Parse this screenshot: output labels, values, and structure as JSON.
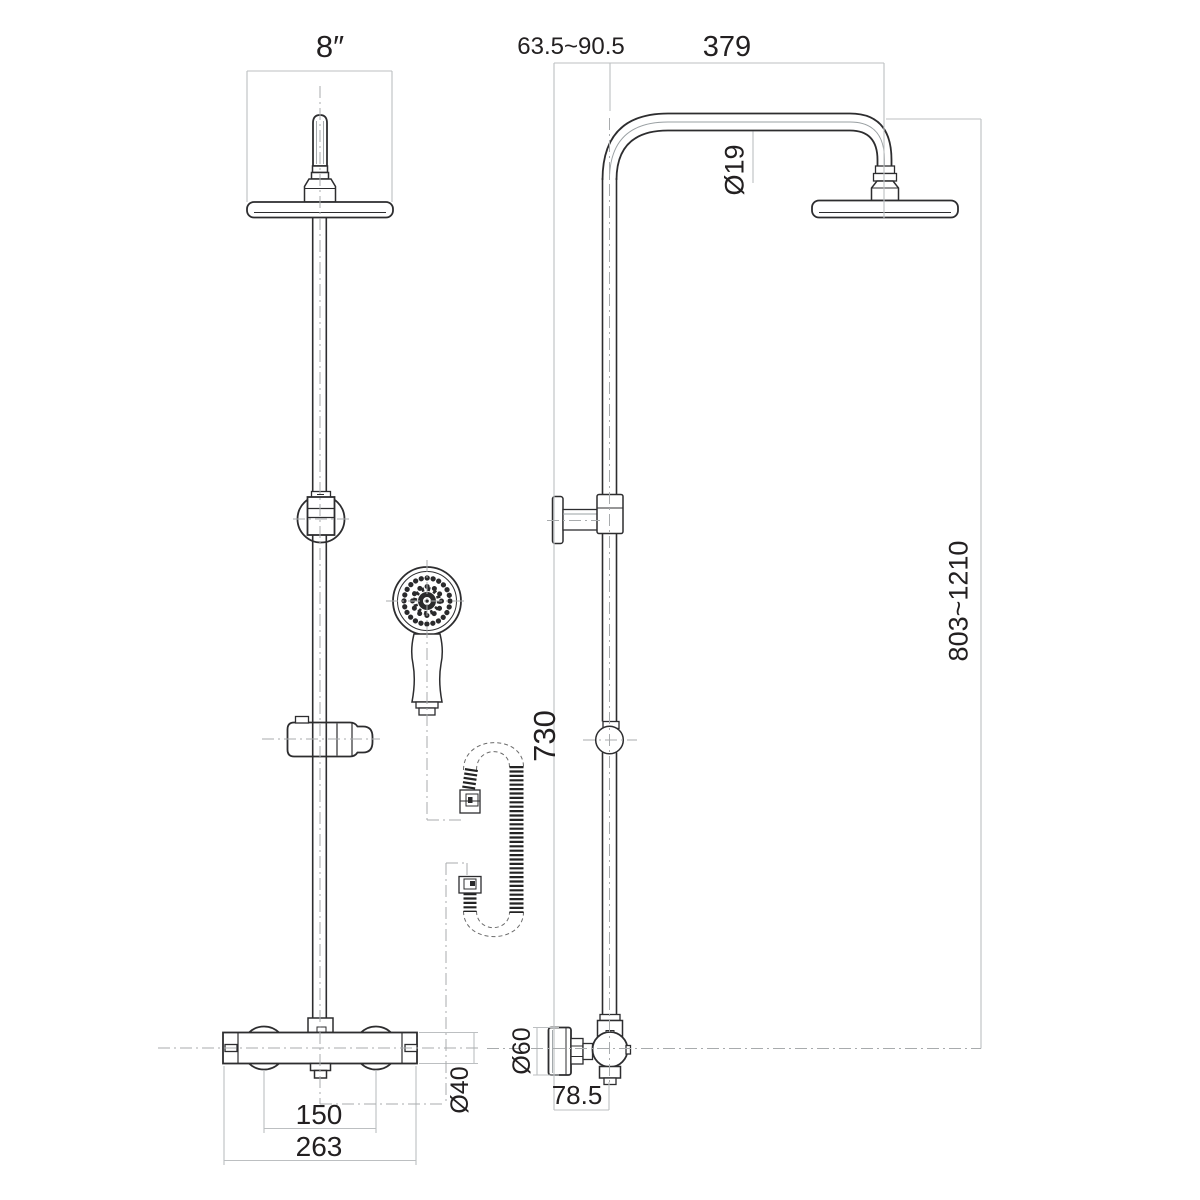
{
  "drawing": {
    "type": "technical dimension drawing",
    "subject": "Thermostatic shower column with overhead rain head, hand shower, hose and bar mixer valve",
    "views": {
      "left": "front elevation",
      "right": "side elevation"
    }
  },
  "dimensions": {
    "head_width": "8″",
    "wall_offset_range": "63.5~90.5",
    "arm_projection": "379",
    "riser_diameter": "Ø19",
    "riser_height_range": "803~1210",
    "valve_to_bracket": "730",
    "knob_diameter": "Ø60",
    "wall_to_riser": "78.5",
    "valve_body_diameter": "Ø40",
    "inlet_centres": "150",
    "valve_width": "263"
  },
  "colors": {
    "background": "#ffffff",
    "outline": "#2d2d2f",
    "dimension_line": "#bcbfc1",
    "centerline": "#a8abad",
    "label_text": "#232021"
  }
}
